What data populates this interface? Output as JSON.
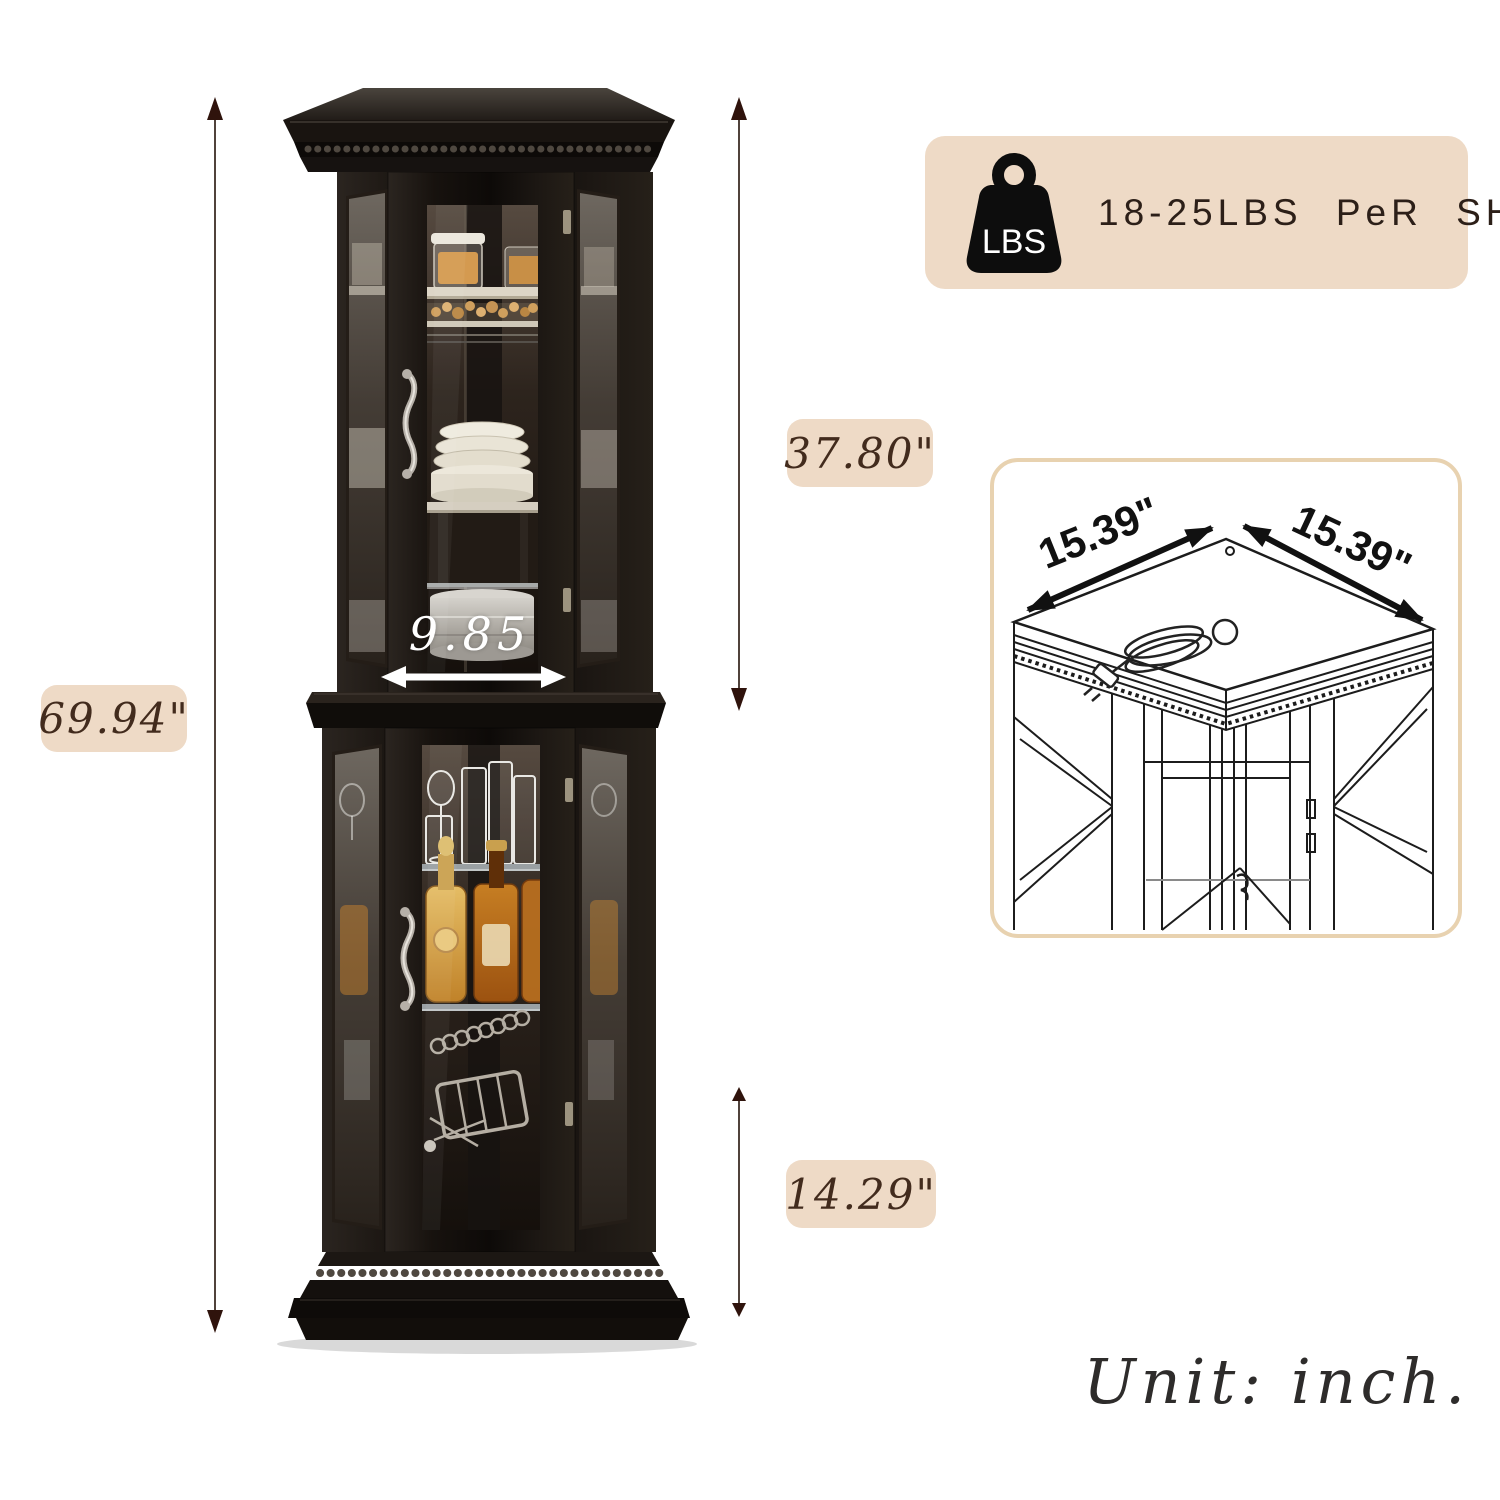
{
  "canvas": {
    "width": 1500,
    "height": 1500,
    "background": "#ffffff"
  },
  "unit_note": "Unit: inch.",
  "weight_badge": {
    "icon_label": "LBS",
    "text": "18-25LBS PeR SHeLF",
    "bg": "#eedac6",
    "icon_color": "#0d0d0d"
  },
  "annotations": {
    "total_height": {
      "label": "69.94\""
    },
    "upper_section_height": {
      "label": "37.80\""
    },
    "lower_section_height": {
      "label": "14.29\""
    },
    "door_width": {
      "label": "9.85"
    },
    "top_depth_left": {
      "label": "15.39\""
    },
    "top_depth_right": {
      "label": "15.39\""
    }
  },
  "cabinet": {
    "style": "black corner curio cabinet with glass doors",
    "upper_shelf_items": "snack jars, cookies, cream plates and bowls",
    "lower_shelf_items": "drinking glasses, amber liquor bottles, bar tools"
  },
  "colors": {
    "badge_bg": "#eedac6",
    "badge_text": "#422b1d",
    "dim_arrow_head": "#2f130c",
    "dim_arrow_line": "#50423b",
    "white_arrow": "#ffffff",
    "panel_border": "#e8d2b0",
    "line_drawing": "#1c1c1c",
    "cabinet_wood": "#14100d"
  }
}
